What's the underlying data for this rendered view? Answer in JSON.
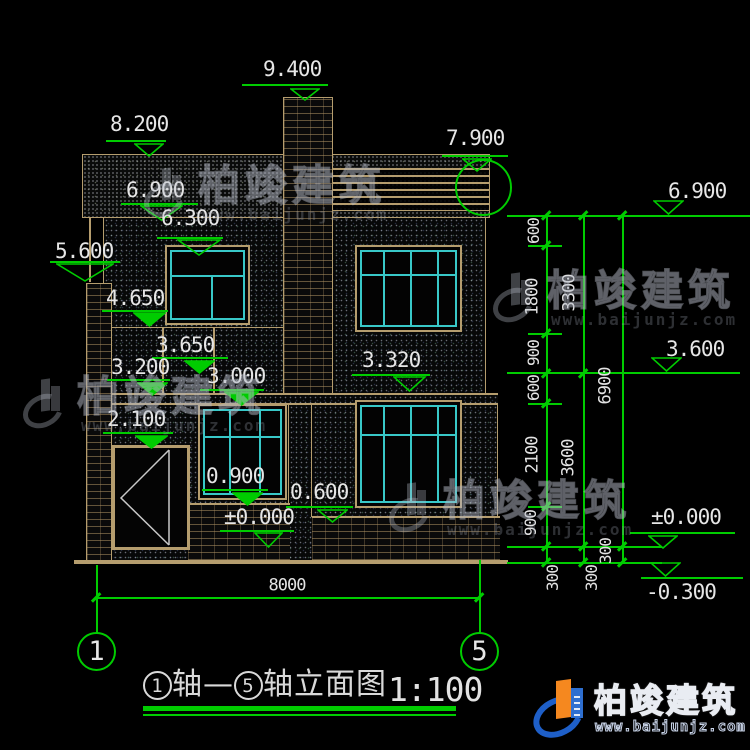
{
  "colors": {
    "green": "#00cc00",
    "tan": "#b59d6e",
    "cyan": "#38c8c8",
    "text_white": "#e6e6e6",
    "logo_blue": "#1e5fc8",
    "logo_orange": "#f5881f"
  },
  "watermark": {
    "brand": "柏竣建筑",
    "url": "www.baijunjz.com"
  },
  "logo": {
    "brand": "柏竣建筑",
    "url": "www.baijunjz.com"
  },
  "title": {
    "axis_start": "1",
    "axis_mid": "轴—",
    "axis_end": "5",
    "suffix": "轴立面图",
    "scale": "1:100"
  },
  "axes": {
    "left": "1",
    "right": "5"
  },
  "elevation_markers": [
    {
      "v": "9.400",
      "lx": 242,
      "ly": 84,
      "lw": 86,
      "tx": 263,
      "ty": 59,
      "cx": 305,
      "tw": 30,
      "th": 13,
      "filled": false,
      "style": "a"
    },
    {
      "v": "8.200",
      "lx": 106,
      "ly": 140,
      "lw": 60,
      "tx": 110,
      "ty": 114,
      "cx": 149,
      "tw": 30,
      "th": 14,
      "filled": false,
      "style": "a"
    },
    {
      "v": "7.900",
      "lx": 442,
      "ly": 155,
      "lw": 66,
      "tx": 446,
      "ty": 128,
      "cx": 477,
      "tw": 30,
      "th": 14,
      "filled": false,
      "style": "a"
    },
    {
      "v": "6.900",
      "lx": 121,
      "ly": 203,
      "lw": 77,
      "tx": 126,
      "ty": 180,
      "cx": 161,
      "tw": 43,
      "th": 16,
      "filled": false,
      "style": "a"
    },
    {
      "v": "6.300",
      "lx": 157,
      "ly": 237,
      "lw": 66,
      "tx": 161,
      "ty": 208,
      "cx": 199,
      "tw": 44,
      "th": 17,
      "filled": false,
      "style": "a"
    },
    {
      "v": "5.600",
      "lx": 50,
      "ly": 261,
      "lw": 70,
      "tx": 55,
      "ty": 241,
      "cx": 85,
      "tw": 58,
      "th": 19,
      "filled": false,
      "style": "a"
    },
    {
      "v": "4.650",
      "lx": 102,
      "ly": 310,
      "lw": 66,
      "tx": 106,
      "ty": 288,
      "cx": 149,
      "tw": 33,
      "th": 15,
      "filled": true,
      "style": "a"
    },
    {
      "v": "3.650",
      "lx": 152,
      "ly": 357,
      "lw": 76,
      "tx": 156,
      "ty": 335,
      "cx": 199,
      "tw": 31,
      "th": 14,
      "filled": true,
      "style": "a"
    },
    {
      "v": "3.200",
      "lx": 107,
      "ly": 379,
      "lw": 63,
      "tx": 111,
      "ty": 357,
      "cx": 152,
      "tw": 31,
      "th": 14,
      "filled": true,
      "style": "a"
    },
    {
      "v": "3.000",
      "lx": 200,
      "ly": 389,
      "lw": 64,
      "tx": 207,
      "ty": 366,
      "cx": 241,
      "tw": 35,
      "th": 15,
      "filled": true,
      "style": "a"
    },
    {
      "v": "3.320",
      "lx": 352,
      "ly": 374,
      "lw": 78,
      "tx": 362,
      "ty": 350,
      "cx": 409,
      "tw": 33,
      "th": 16,
      "filled": false,
      "style": "a"
    },
    {
      "v": "2.100",
      "lx": 103,
      "ly": 432,
      "lw": 70,
      "tx": 107,
      "ty": 409,
      "cx": 151,
      "tw": 33,
      "th": 14,
      "filled": true,
      "style": "a"
    },
    {
      "v": "0.900",
      "lx": 202,
      "ly": 489,
      "lw": 66,
      "tx": 206,
      "ty": 466,
      "cx": 247,
      "tw": 31,
      "th": 14,
      "filled": true,
      "style": "a"
    },
    {
      "v": "0.600",
      "lx": 286,
      "ly": 506,
      "lw": 67,
      "tx": 290,
      "ty": 482,
      "cx": 332,
      "tw": 31,
      "th": 14,
      "filled": false,
      "style": "a"
    },
    {
      "v": "±0.000",
      "lx": 220,
      "ly": 530,
      "lw": 74,
      "tx": 224,
      "ty": 507,
      "cx": 268,
      "tw": 29,
      "th": 16,
      "filled": false,
      "style": "a"
    },
    {
      "v": "6.900",
      "lx": 507,
      "ly": 215,
      "lw": 243,
      "tx": 668,
      "ty": 181,
      "cx": 668,
      "tw": 31,
      "th": 15,
      "filled": false,
      "style": "b"
    },
    {
      "v": "3.600",
      "lx": 507,
      "ly": 372,
      "lw": 233,
      "tx": 666,
      "ty": 339,
      "cx": 666,
      "tw": 31,
      "th": 15,
      "filled": false,
      "style": "b"
    },
    {
      "v": "±0.000",
      "lx": 630,
      "ly": 532,
      "lw": 105,
      "tx": 651,
      "ty": 507,
      "cx": 663,
      "tw": 30,
      "th": 14,
      "filled": false,
      "style": "a"
    },
    {
      "v": "-0.300",
      "lx": 641,
      "ly": 577,
      "lw": 102,
      "tx": 646,
      "ty": 582,
      "cx": 665,
      "tw": 31,
      "th": 15,
      "filled": false,
      "style": "b"
    }
  ],
  "dim_labels": [
    {
      "t": "600",
      "x": 534,
      "y": 231,
      "r": -90
    },
    {
      "t": "1800",
      "x": 533,
      "y": 297,
      "r": -90
    },
    {
      "t": "900",
      "x": 534,
      "y": 353,
      "r": -90
    },
    {
      "t": "600",
      "x": 534,
      "y": 388,
      "r": -90
    },
    {
      "t": "2100",
      "x": 533,
      "y": 455,
      "r": -90
    },
    {
      "t": "900",
      "x": 531,
      "y": 523,
      "r": -90
    },
    {
      "t": "300",
      "x": 553,
      "y": 578,
      "r": -90
    },
    {
      "t": "3300",
      "x": 570,
      "y": 293,
      "r": -90
    },
    {
      "t": "3600",
      "x": 569,
      "y": 458,
      "r": -90
    },
    {
      "t": "300",
      "x": 592,
      "y": 578,
      "r": -90
    },
    {
      "t": "6900",
      "x": 606,
      "y": 386,
      "r": -90
    },
    {
      "t": "300",
      "x": 606,
      "y": 551,
      "r": -90
    },
    {
      "t": "8000",
      "x": 287,
      "y": 586,
      "r": 0
    }
  ],
  "green_lines": [
    {
      "x": 528,
      "y": 245,
      "w": 34,
      "h": 0
    },
    {
      "x": 528,
      "y": 333,
      "w": 34,
      "h": 0
    },
    {
      "x": 528,
      "y": 403,
      "w": 34,
      "h": 0
    },
    {
      "x": 528,
      "y": 506,
      "w": 34,
      "h": 0
    },
    {
      "x": 507,
      "y": 546,
      "w": 155,
      "h": 0
    },
    {
      "x": 507,
      "y": 562,
      "w": 155,
      "h": 0
    },
    {
      "x": 546,
      "y": 215,
      "w": 0,
      "h": 347
    },
    {
      "x": 583,
      "y": 215,
      "w": 0,
      "h": 347
    },
    {
      "x": 622,
      "y": 215,
      "w": 0,
      "h": 347
    },
    {
      "x": 96,
      "y": 597,
      "w": 383,
      "h": 0
    },
    {
      "x": 96,
      "y": 565,
      "w": 0,
      "h": 33
    },
    {
      "x": 96,
      "y": 598,
      "w": 0,
      "h": 35
    },
    {
      "x": 479,
      "y": 560,
      "w": 0,
      "h": 38
    },
    {
      "x": 479,
      "y": 598,
      "w": 0,
      "h": 35
    },
    {
      "x": 143,
      "y": 706,
      "w": 313,
      "h": 0,
      "t": 5
    },
    {
      "x": 143,
      "y": 714,
      "w": 313,
      "h": 0,
      "t": 2
    }
  ],
  "tan_lines": [
    {
      "x": 89,
      "y": 218,
      "w": 0,
      "h": 64
    }
  ],
  "ticks": [
    [
      546,
      215
    ],
    [
      546,
      245
    ],
    [
      546,
      333
    ],
    [
      546,
      373
    ],
    [
      546,
      403
    ],
    [
      546,
      506
    ],
    [
      546,
      546
    ],
    [
      546,
      562
    ],
    [
      583,
      215
    ],
    [
      583,
      373
    ],
    [
      583,
      546
    ],
    [
      583,
      562
    ],
    [
      622,
      215
    ],
    [
      622,
      546
    ],
    [
      622,
      562
    ],
    [
      96,
      597
    ],
    [
      479,
      597
    ]
  ],
  "windows": [
    {
      "name": "window-2f-left",
      "x": 165,
      "y": 245,
      "w": 85,
      "h": 80,
      "transom": 28,
      "mullions": [
        44
      ],
      "mull_from_transom": true
    },
    {
      "name": "window-2f-right",
      "x": 355,
      "y": 245,
      "w": 107,
      "h": 87,
      "transom": 27,
      "mullions": [
        26,
        53,
        80
      ],
      "mull_from_transom": false
    },
    {
      "name": "window-1f-right",
      "x": 355,
      "y": 400,
      "w": 107,
      "h": 108,
      "transom": 32,
      "mullions": [
        26,
        53,
        80
      ],
      "mull_from_transom": false
    },
    {
      "name": "porch-window",
      "x": 198,
      "y": 404,
      "w": 89,
      "h": 96,
      "transom": 30,
      "mullions": [
        29,
        59
      ],
      "mull_from_transom": false
    }
  ],
  "watermark_positions": [
    {
      "x": 143,
      "y": 163
    },
    {
      "x": 22,
      "y": 374
    },
    {
      "x": 492,
      "y": 268
    },
    {
      "x": 388,
      "y": 478
    }
  ]
}
